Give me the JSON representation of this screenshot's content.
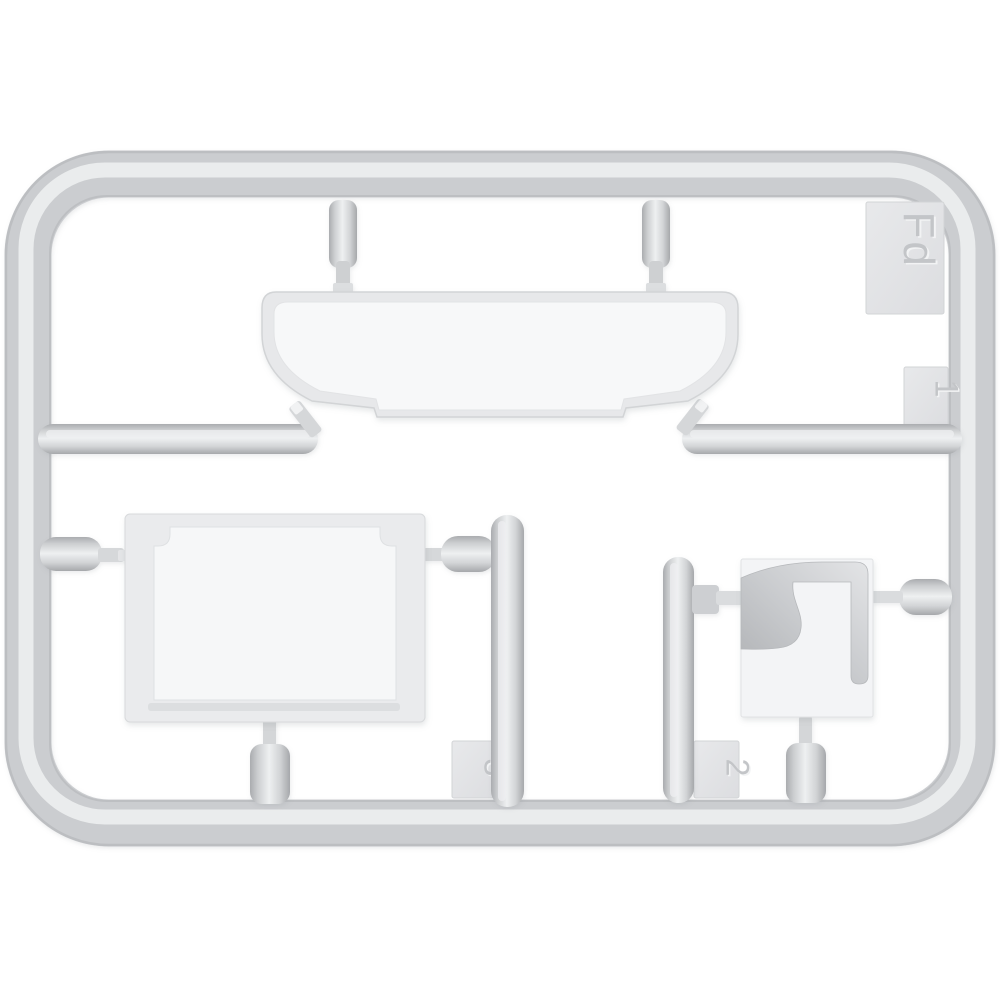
{
  "scene": {
    "description": "Light-gray injection-molded plastic model-kit sprue (parts tree) photographed on a plain white background",
    "background_color": "#ffffff",
    "plastic_color": "#d2d4d6",
    "part_surface_color": "#f6f7f8",
    "tab_color": "#e2e3e5"
  },
  "labels": {
    "sprue_id": "Fd",
    "part_1": "1",
    "part_2": "2",
    "part_3": "3"
  },
  "parts": [
    {
      "number": "1",
      "name": "curved tub / hull-shaped panel",
      "position": "top center, hung from two round gates"
    },
    {
      "number": "2",
      "name": "small square bracket with raised S-shaped ridge",
      "position": "bottom right"
    },
    {
      "number": "3",
      "name": "large rectangular recessed panel",
      "position": "bottom left"
    }
  ]
}
